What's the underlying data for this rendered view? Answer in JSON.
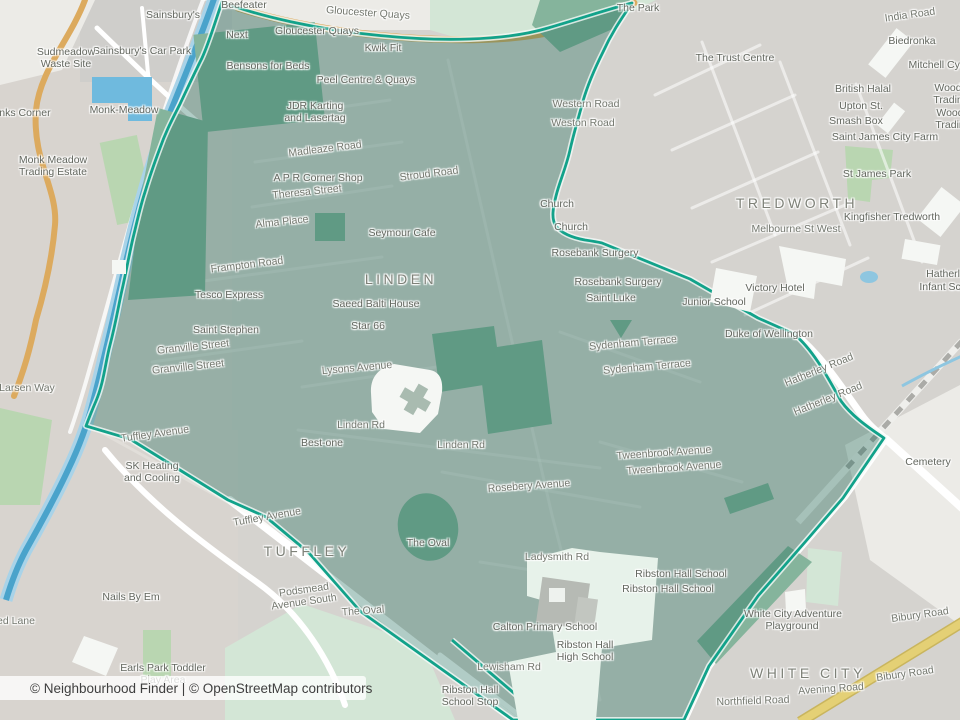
{
  "map": {
    "attribution": {
      "prefix": "© Neighbourhood Finder | ",
      "osm_link": "© OpenStreetMap contributors"
    },
    "colors": {
      "base": "#d5d3cf",
      "boundary": "#12a28a",
      "overlayFill": "rgba(25,105,88,0.34)",
      "water": "#4aa3cb",
      "waterLight": "#a9d3e8",
      "parkOuter": "#b9d6b1",
      "parkPale": "#d3e6d6",
      "parkInner": "#85b49c",
      "roadOrange": "#dcaa5e",
      "roadYellow": "#e4d075"
    },
    "labels": [
      {
        "t": "Sainsbury's",
        "x": 173,
        "y": 15,
        "c": "poi"
      },
      {
        "t": "Sainsbury's Car Park",
        "x": 142,
        "y": 51,
        "c": "poi"
      },
      {
        "t": "Beefeater",
        "x": 244,
        "y": 5,
        "c": "poi"
      },
      {
        "t": "Gloucester Quays",
        "x": 368,
        "y": 13,
        "c": "road",
        "r": 4
      },
      {
        "t": "Gloucester Quays",
        "x": 317,
        "y": 31,
        "c": "poi"
      },
      {
        "t": "Next",
        "x": 237,
        "y": 35,
        "c": "poi"
      },
      {
        "t": "Kwik Fit",
        "x": 383,
        "y": 48,
        "c": "poi"
      },
      {
        "t": "Sudmeadow",
        "x": 66,
        "y": 52,
        "c": "poi"
      },
      {
        "t": "Waste Site",
        "x": 66,
        "y": 64,
        "c": "poi"
      },
      {
        "t": "Bensons for Beds",
        "x": 268,
        "y": 66,
        "c": "poi"
      },
      {
        "t": "Peel Centre & Quays",
        "x": 366,
        "y": 80,
        "c": "poi"
      },
      {
        "t": "JDR Karting",
        "x": 315,
        "y": 106,
        "c": "poi"
      },
      {
        "t": "and Lasertag",
        "x": 315,
        "y": 118,
        "c": "poi"
      },
      {
        "t": "Monk-Meadow",
        "x": 124,
        "y": 110,
        "c": "poi"
      },
      {
        "t": "anks Corner",
        "x": 22,
        "y": 113,
        "c": "poi"
      },
      {
        "t": "The Park",
        "x": 638,
        "y": 8,
        "c": "poi"
      },
      {
        "t": "India Road",
        "x": 910,
        "y": 15,
        "c": "road",
        "r": -8
      },
      {
        "t": "Biedronka",
        "x": 912,
        "y": 41,
        "c": "poi"
      },
      {
        "t": "The Trust Centre",
        "x": 735,
        "y": 58,
        "c": "poi"
      },
      {
        "t": "Mitchell Cycl",
        "x": 938,
        "y": 65,
        "c": "poi"
      },
      {
        "t": "Wood",
        "x": 948,
        "y": 88,
        "c": "poi"
      },
      {
        "t": "Trading",
        "x": 951,
        "y": 100,
        "c": "poi"
      },
      {
        "t": "British Halal",
        "x": 863,
        "y": 89,
        "c": "poi"
      },
      {
        "t": "Upton St.",
        "x": 861,
        "y": 106,
        "c": "poi"
      },
      {
        "t": "Wood",
        "x": 950,
        "y": 113,
        "c": "poi"
      },
      {
        "t": "Trading",
        "x": 953,
        "y": 125,
        "c": "poi"
      },
      {
        "t": "Smash Box",
        "x": 856,
        "y": 121,
        "c": "poi"
      },
      {
        "t": "Saint James City Farm",
        "x": 885,
        "y": 137,
        "c": "poi"
      },
      {
        "t": "Monk Meadow",
        "x": 53,
        "y": 160,
        "c": "poi"
      },
      {
        "t": "Trading Estate",
        "x": 53,
        "y": 172,
        "c": "poi"
      },
      {
        "t": "Madleaze Road",
        "x": 325,
        "y": 149,
        "c": "road",
        "r": -7
      },
      {
        "t": "Western Road",
        "x": 586,
        "y": 104,
        "c": "road"
      },
      {
        "t": "Weston Road",
        "x": 583,
        "y": 123,
        "c": "road"
      },
      {
        "t": "Stroud Road",
        "x": 429,
        "y": 174,
        "c": "road",
        "r": -7
      },
      {
        "t": "A P R Corner Shop",
        "x": 318,
        "y": 178,
        "c": "poi"
      },
      {
        "t": "Theresa Street",
        "x": 307,
        "y": 192,
        "c": "road",
        "r": -6
      },
      {
        "t": "St James Park",
        "x": 877,
        "y": 174,
        "c": "poi"
      },
      {
        "t": "TREDWORTH",
        "x": 797,
        "y": 203,
        "c": "place"
      },
      {
        "t": "Church",
        "x": 557,
        "y": 204,
        "c": "poi"
      },
      {
        "t": "Kingfisher Tredworth",
        "x": 892,
        "y": 217,
        "c": "poi"
      },
      {
        "t": "Alma Place",
        "x": 282,
        "y": 222,
        "c": "road",
        "r": -6
      },
      {
        "t": "Church",
        "x": 571,
        "y": 227,
        "c": "poi"
      },
      {
        "t": "Melbourne St West",
        "x": 796,
        "y": 229,
        "c": "road"
      },
      {
        "t": "Seymour Cafe",
        "x": 402,
        "y": 233,
        "c": "poi"
      },
      {
        "t": "Rosebank Surgery",
        "x": 595,
        "y": 253,
        "c": "poi"
      },
      {
        "t": "Frampton Road",
        "x": 247,
        "y": 265,
        "c": "road",
        "r": -7
      },
      {
        "t": "LINDEN",
        "x": 401,
        "y": 279,
        "c": "place"
      },
      {
        "t": "Rosebank Surgery",
        "x": 618,
        "y": 282,
        "c": "poi"
      },
      {
        "t": "Victory Hotel",
        "x": 775,
        "y": 288,
        "c": "poi"
      },
      {
        "t": "Tesco Express",
        "x": 229,
        "y": 295,
        "c": "poi"
      },
      {
        "t": "Saint Luke",
        "x": 611,
        "y": 298,
        "c": "poi"
      },
      {
        "t": "Junior School",
        "x": 714,
        "y": 302,
        "c": "poi"
      },
      {
        "t": "Saeed Balti House",
        "x": 376,
        "y": 304,
        "c": "poi"
      },
      {
        "t": "Star 66",
        "x": 368,
        "y": 326,
        "c": "poi"
      },
      {
        "t": "Saint Stephen",
        "x": 226,
        "y": 330,
        "c": "poi"
      },
      {
        "t": "Duke of Wellington",
        "x": 769,
        "y": 334,
        "c": "poi"
      },
      {
        "t": "Sydenham Terrace",
        "x": 633,
        "y": 343,
        "c": "road",
        "r": -5
      },
      {
        "t": "Granville Street",
        "x": 193,
        "y": 347,
        "c": "road",
        "r": -6
      },
      {
        "t": "Granville Street",
        "x": 188,
        "y": 367,
        "c": "road",
        "r": -6
      },
      {
        "t": "Sydenham Terrace",
        "x": 647,
        "y": 367,
        "c": "road",
        "r": -5
      },
      {
        "t": "Lysons Avenue",
        "x": 357,
        "y": 368,
        "c": "road",
        "r": -5
      },
      {
        "t": "Hatherley Road",
        "x": 819,
        "y": 370,
        "c": "road",
        "r": -22
      },
      {
        "t": "Hatherley Road",
        "x": 828,
        "y": 399,
        "c": "road",
        "r": -22
      },
      {
        "t": "Larsen Way",
        "x": 27,
        "y": 388,
        "c": "road"
      },
      {
        "t": "Linden Rd",
        "x": 361,
        "y": 425,
        "c": "road"
      },
      {
        "t": "Tuffley Avenue",
        "x": 155,
        "y": 434,
        "c": "road",
        "r": -8
      },
      {
        "t": "Best-one",
        "x": 322,
        "y": 443,
        "c": "poi"
      },
      {
        "t": "Linden Rd",
        "x": 461,
        "y": 445,
        "c": "road"
      },
      {
        "t": "Tweenbrook Avenue",
        "x": 664,
        "y": 453,
        "c": "road",
        "r": -4
      },
      {
        "t": "Cemetery",
        "x": 928,
        "y": 462,
        "c": "poi"
      },
      {
        "t": "Tweenbrook Avenue",
        "x": 674,
        "y": 468,
        "c": "road",
        "r": -4
      },
      {
        "t": "SK Heating",
        "x": 152,
        "y": 466,
        "c": "poi"
      },
      {
        "t": "and Cooling",
        "x": 152,
        "y": 478,
        "c": "poi"
      },
      {
        "t": "Rosebery Avenue",
        "x": 529,
        "y": 486,
        "c": "road",
        "r": -4
      },
      {
        "t": "Tuffley Avenue",
        "x": 267,
        "y": 517,
        "c": "road",
        "r": -10
      },
      {
        "t": "The Oval",
        "x": 428,
        "y": 543,
        "c": "poi"
      },
      {
        "t": "TUFFLEY",
        "x": 307,
        "y": 551,
        "c": "place"
      },
      {
        "t": "Ladysmith Rd",
        "x": 557,
        "y": 557,
        "c": "road"
      },
      {
        "t": "Ribston Hall School",
        "x": 681,
        "y": 574,
        "c": "poi"
      },
      {
        "t": "Ribston Hall School",
        "x": 668,
        "y": 589,
        "c": "poi"
      },
      {
        "t": "Podsmead",
        "x": 304,
        "y": 590,
        "c": "road",
        "r": -8
      },
      {
        "t": "Avenue South",
        "x": 304,
        "y": 602,
        "c": "road",
        "r": -8
      },
      {
        "t": "Nails By Em",
        "x": 131,
        "y": 597,
        "c": "poi"
      },
      {
        "t": "The Oval",
        "x": 363,
        "y": 611,
        "c": "road",
        "r": -4
      },
      {
        "t": "White City Adventure",
        "x": 793,
        "y": 614,
        "c": "poi"
      },
      {
        "t": "Playground",
        "x": 792,
        "y": 626,
        "c": "poi"
      },
      {
        "t": "Bibury Road",
        "x": 920,
        "y": 615,
        "c": "road",
        "r": -8
      },
      {
        "t": "ed Lane",
        "x": 16,
        "y": 621,
        "c": "road"
      },
      {
        "t": "Calton Primary School",
        "x": 545,
        "y": 627,
        "c": "poi"
      },
      {
        "t": "Ribston Hall",
        "x": 585,
        "y": 645,
        "c": "poi"
      },
      {
        "t": "High School",
        "x": 585,
        "y": 657,
        "c": "poi"
      },
      {
        "t": "Earls Park Toddler",
        "x": 163,
        "y": 668,
        "c": "poi"
      },
      {
        "t": "Play Area",
        "x": 163,
        "y": 680,
        "c": "poi"
      },
      {
        "t": "Lewisham Rd",
        "x": 509,
        "y": 667,
        "c": "road"
      },
      {
        "t": "WHITE CITY",
        "x": 808,
        "y": 673,
        "c": "place"
      },
      {
        "t": "Avening Road",
        "x": 831,
        "y": 689,
        "c": "road",
        "r": -4
      },
      {
        "t": "Bibury Road",
        "x": 905,
        "y": 674,
        "c": "road",
        "r": -8
      },
      {
        "t": "Northfield Road",
        "x": 753,
        "y": 701,
        "c": "road",
        "r": -2
      },
      {
        "t": "Ribston Hall",
        "x": 470,
        "y": 690,
        "c": "poi"
      },
      {
        "t": "School Stop",
        "x": 470,
        "y": 702,
        "c": "poi"
      },
      {
        "t": "Hatherle",
        "x": 946,
        "y": 274,
        "c": "poi"
      },
      {
        "t": "Infant Sch",
        "x": 943,
        "y": 287,
        "c": "poi"
      }
    ]
  }
}
